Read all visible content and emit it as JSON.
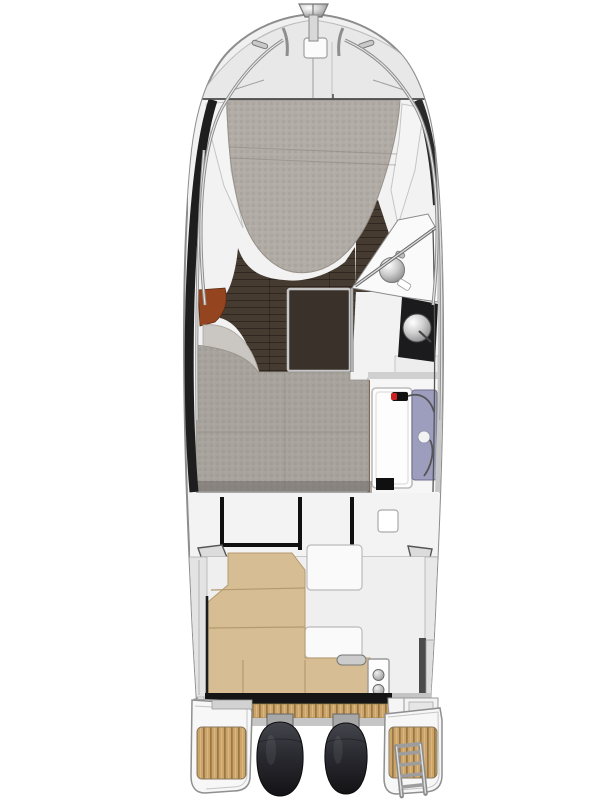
{
  "diagram": {
    "title": "Motor boat deck and interior layout plan (top view)",
    "type": "boat-floor-plan",
    "parts": {
      "bow": [
        "anchor-roller",
        "anchor-locker-hatch",
        "bow-rail-port",
        "bow-rail-starboard",
        "bow-cleat-port",
        "bow-cleat-starboard",
        "foredeck"
      ],
      "forward-cabin": [
        "v-berth-mattress",
        "side-shelf-port",
        "side-shelf-starboard"
      ],
      "saloon": [
        "wood-floor",
        "dinette-table",
        "port-seat-backrest",
        "port-seat-cushion"
      ],
      "galley": [
        "counter",
        "sink",
        "stove-counter",
        "stove-lid",
        "handrail"
      ],
      "head-compartment": [
        "shower-tray",
        "door-panel",
        "shower-faucet",
        "shower-hose"
      ],
      "mid-cabin": [
        "berth-mattress"
      ],
      "wheelhouse": [
        "rear-window-frame",
        "roof-hatch"
      ],
      "cockpit": [
        "l-shaped-bench",
        "bench-grab-handle",
        "stern-module",
        "port-gunwale",
        "starboard-gate",
        "storage-boxes"
      ],
      "stern": [
        "transom-beam",
        "transom-teak-step",
        "outboard-engine-port",
        "outboard-engine-starboard",
        "engine-mounts",
        "port-swim-platform",
        "starboard-swim-platform",
        "boarding-ladder"
      ]
    }
  },
  "colors": {
    "page_bg": "#ffffff",
    "hull_fill": "#f0f0f0",
    "hull_stroke": "#8d8d8d",
    "bulwark_line": "#bfbfbf",
    "foredeck": "#e8e8e8",
    "interior_base": "#f2f2f2",
    "cut_line": "#4a4a4a",
    "wall_dark": "#1e1e1e",
    "bed_carpet": "#b2aca6",
    "mid_carpet": "#a8a39d",
    "carpet_seam": "#8a847d",
    "wood": "#463b30",
    "table_top": "#3a312a",
    "table_frame": "#c6c6c6",
    "seat_red": "#94451f",
    "seat_gray": "#cac7c3",
    "galley_white": "#fafafa",
    "counter_black": "#1b1b1d",
    "lavender": "#9d9dbe",
    "faucet_red": "#cc2222",
    "bench_beige": "#d7bd93",
    "bench_edge": "#b49a6e",
    "cockpit_floor": "#efefef",
    "gunwale": "#e3e3e3",
    "frame_black": "#101010",
    "transom_black": "#151515",
    "teak_base": "#cda467",
    "teak_stripe": "#8c7040",
    "platform_white": "#f7f7f7",
    "engine_top": "#45454d",
    "engine_mid": "#2a2a31",
    "engine_bottom": "#131316",
    "ladder_gray": "#8b8b8b",
    "gate_dark": "#4a4a4a",
    "metal_light": "#ffffff",
    "metal_mid": "#cfcfcf",
    "metal_dark": "#5f5f5f",
    "module_white": "#fdfdfd",
    "knob_gray": "#c2c2c2",
    "shade_band": "#6f6c68"
  }
}
